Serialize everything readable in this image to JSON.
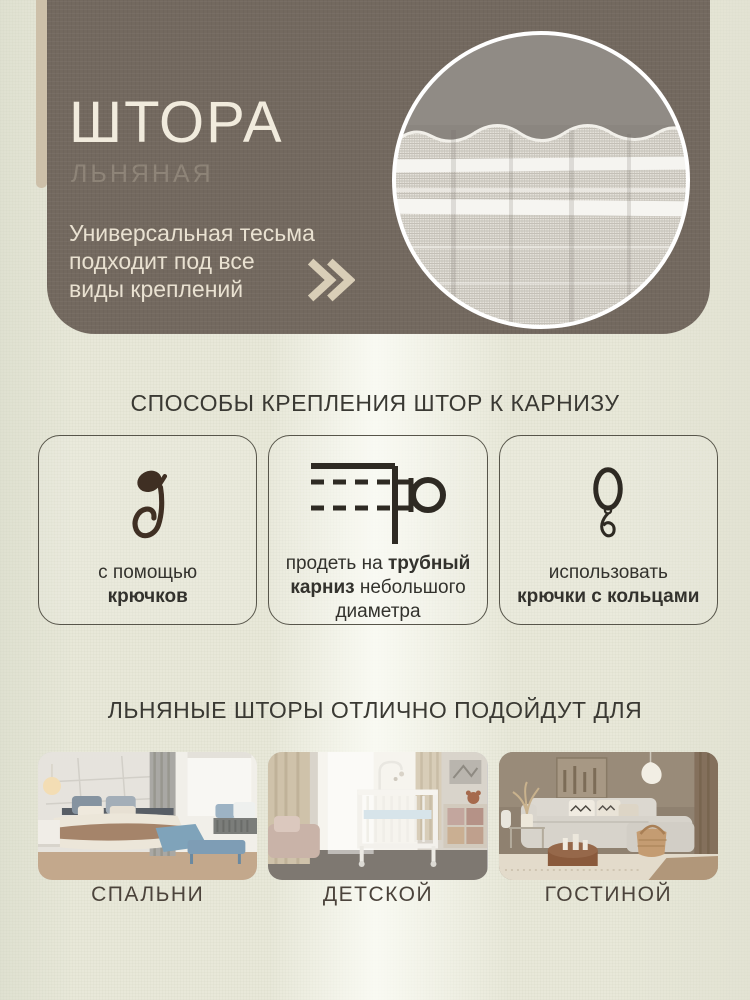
{
  "colors": {
    "background": "#e8e8d9",
    "hero_card": "#73695f",
    "accent_bar": "#cdc0a9",
    "title_text": "#f1ebdd",
    "subtitle_text": "#8e8478",
    "hero_description_text": "#e9e1d1",
    "chevron": "#d9ceb7",
    "heading_text": "#3a3933",
    "card_border": "#57554a",
    "card_text": "#33322d",
    "hook_icon": "#3f2f23",
    "rod_ring_icon": "#2e2a23",
    "room_label_text": "#4b433b"
  },
  "hero": {
    "title": "ШТОРА",
    "subtitle": "ЛЬНЯНАЯ",
    "description": "Универсальная тесьма\nподходит под все\nвиды креплений"
  },
  "attachment": {
    "heading": "СПОСОБЫ КРЕПЛЕНИЯ ШТОР К КАРНИЗУ",
    "cards": [
      {
        "icon": "curtain-hook-icon",
        "regular": "с помощью",
        "bold": "крючков"
      },
      {
        "icon": "curtain-rod-icon",
        "pre": "продеть на ",
        "bold": "трубный карниз",
        "post": " небольшого диаметра"
      },
      {
        "icon": "curtain-ring-icon",
        "regular": "использовать",
        "bold": "крючки с кольцами"
      }
    ]
  },
  "rooms": {
    "heading": "ЛЬНЯНЫЕ ШТОРЫ ОТЛИЧНО ПОДОЙДУТ ДЛЯ",
    "items": [
      {
        "label": "СПАЛЬНИ",
        "scene": "bedroom"
      },
      {
        "label": "ДЕТСКОЙ",
        "scene": "nursery"
      },
      {
        "label": "ГОСТИНОЙ",
        "scene": "living-room"
      }
    ]
  }
}
